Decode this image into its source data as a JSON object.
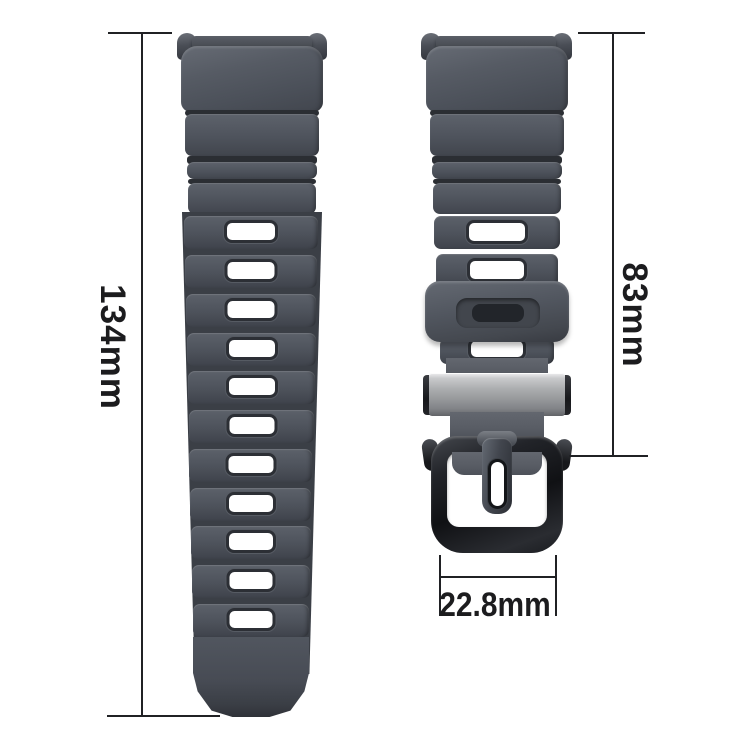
{
  "page": {
    "background": "#ffffff"
  },
  "diagram": {
    "title": "watch strap dimension diagram",
    "colors": {
      "strap_rubber": "#4d525a",
      "strap_shadow": "#363a41",
      "buckle_black": "#1a1c20",
      "metal_slider": "#a8aaac",
      "dimension_line": "#202124",
      "label_text": "#1c1c1e"
    },
    "dimensions": {
      "strap_length": {
        "label": "134mm",
        "orientation": "vertical"
      },
      "buckle_strap_length": {
        "label": "83mm",
        "orientation": "vertical"
      },
      "strap_width": {
        "label": "22.8mm",
        "orientation": "horizontal"
      }
    },
    "parts": {
      "long_strap": {
        "adjustment_holes": 11
      },
      "buckle_strap": {
        "slots": 3
      },
      "keeper_loop": {},
      "metal_slider": {},
      "buckle": {}
    }
  }
}
